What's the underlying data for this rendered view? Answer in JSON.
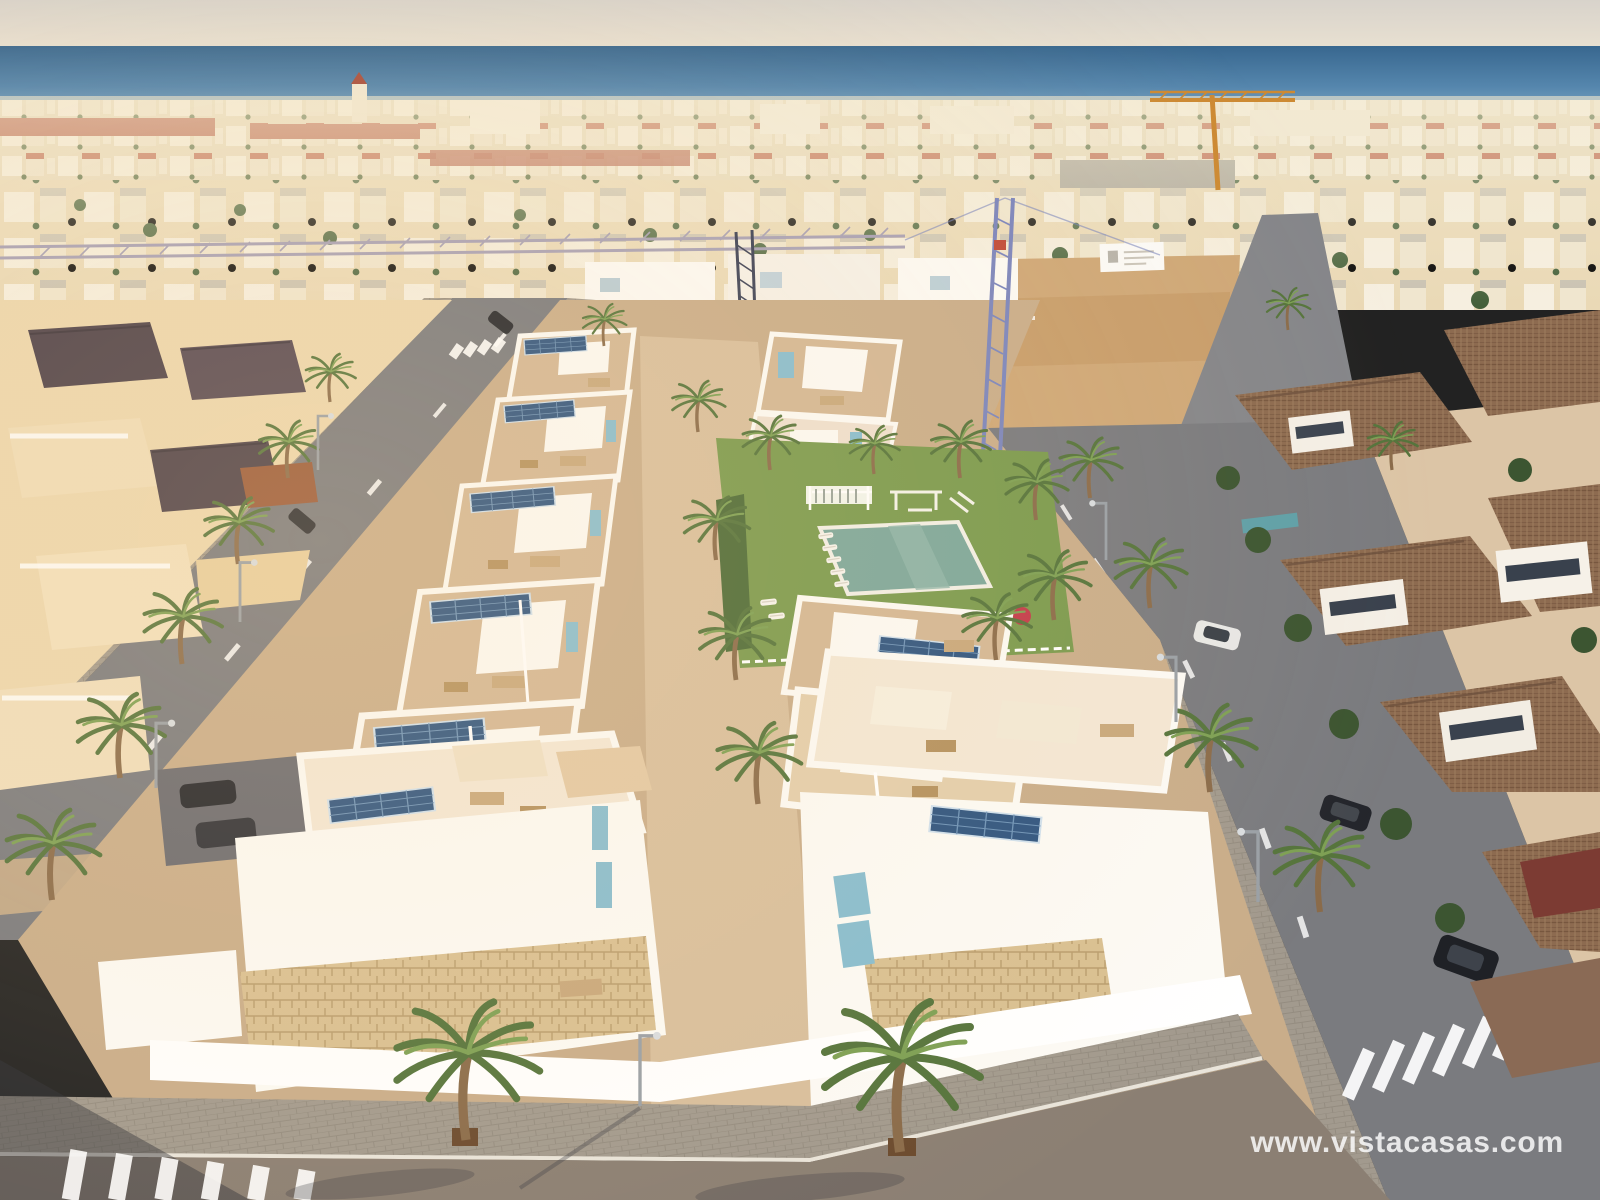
{
  "watermark": {
    "text": "www.vistacasas.com"
  },
  "scene_title": "Aerial 3D render of a new-build villa development by the sea",
  "colors": {
    "sky_top": "#d8d3cb",
    "sky_bottom": "#ece3d2",
    "sea_deep": "#38678f",
    "sea_light": "#86acc7",
    "shoreline": "#d9cdb2",
    "city_base": "#e7d9ba",
    "roof_red": "#b45a45",
    "sand_lot": "#cfa878",
    "dev_ground": "#c9ad8a",
    "promenade": "#d8bf9d",
    "wall_white": "#fcfaf5",
    "terrace": "#d3b795",
    "stone": "#d5ba8c",
    "solar_panel": "#2e5480",
    "glass_blue": "#87bdd0",
    "lawn": "#7a9a4e",
    "pool_water": "#7ca79b",
    "palm_green": "#5d7d3f",
    "tile_roof": "#8d6b50",
    "cream_villa": "#f0debc",
    "road": "#7a7b7f",
    "asphalt_warm": "#8b7f73",
    "sidewalk": "#a29a8e",
    "crane_blue": "#7b85bd",
    "crane_orange": "#cd8a33",
    "car_white": "#e8e8e6",
    "car_dark": "#24262c",
    "car_green": "#3f6148",
    "hedge_green": "#3c5531",
    "flower_red": "#c23a4a"
  }
}
